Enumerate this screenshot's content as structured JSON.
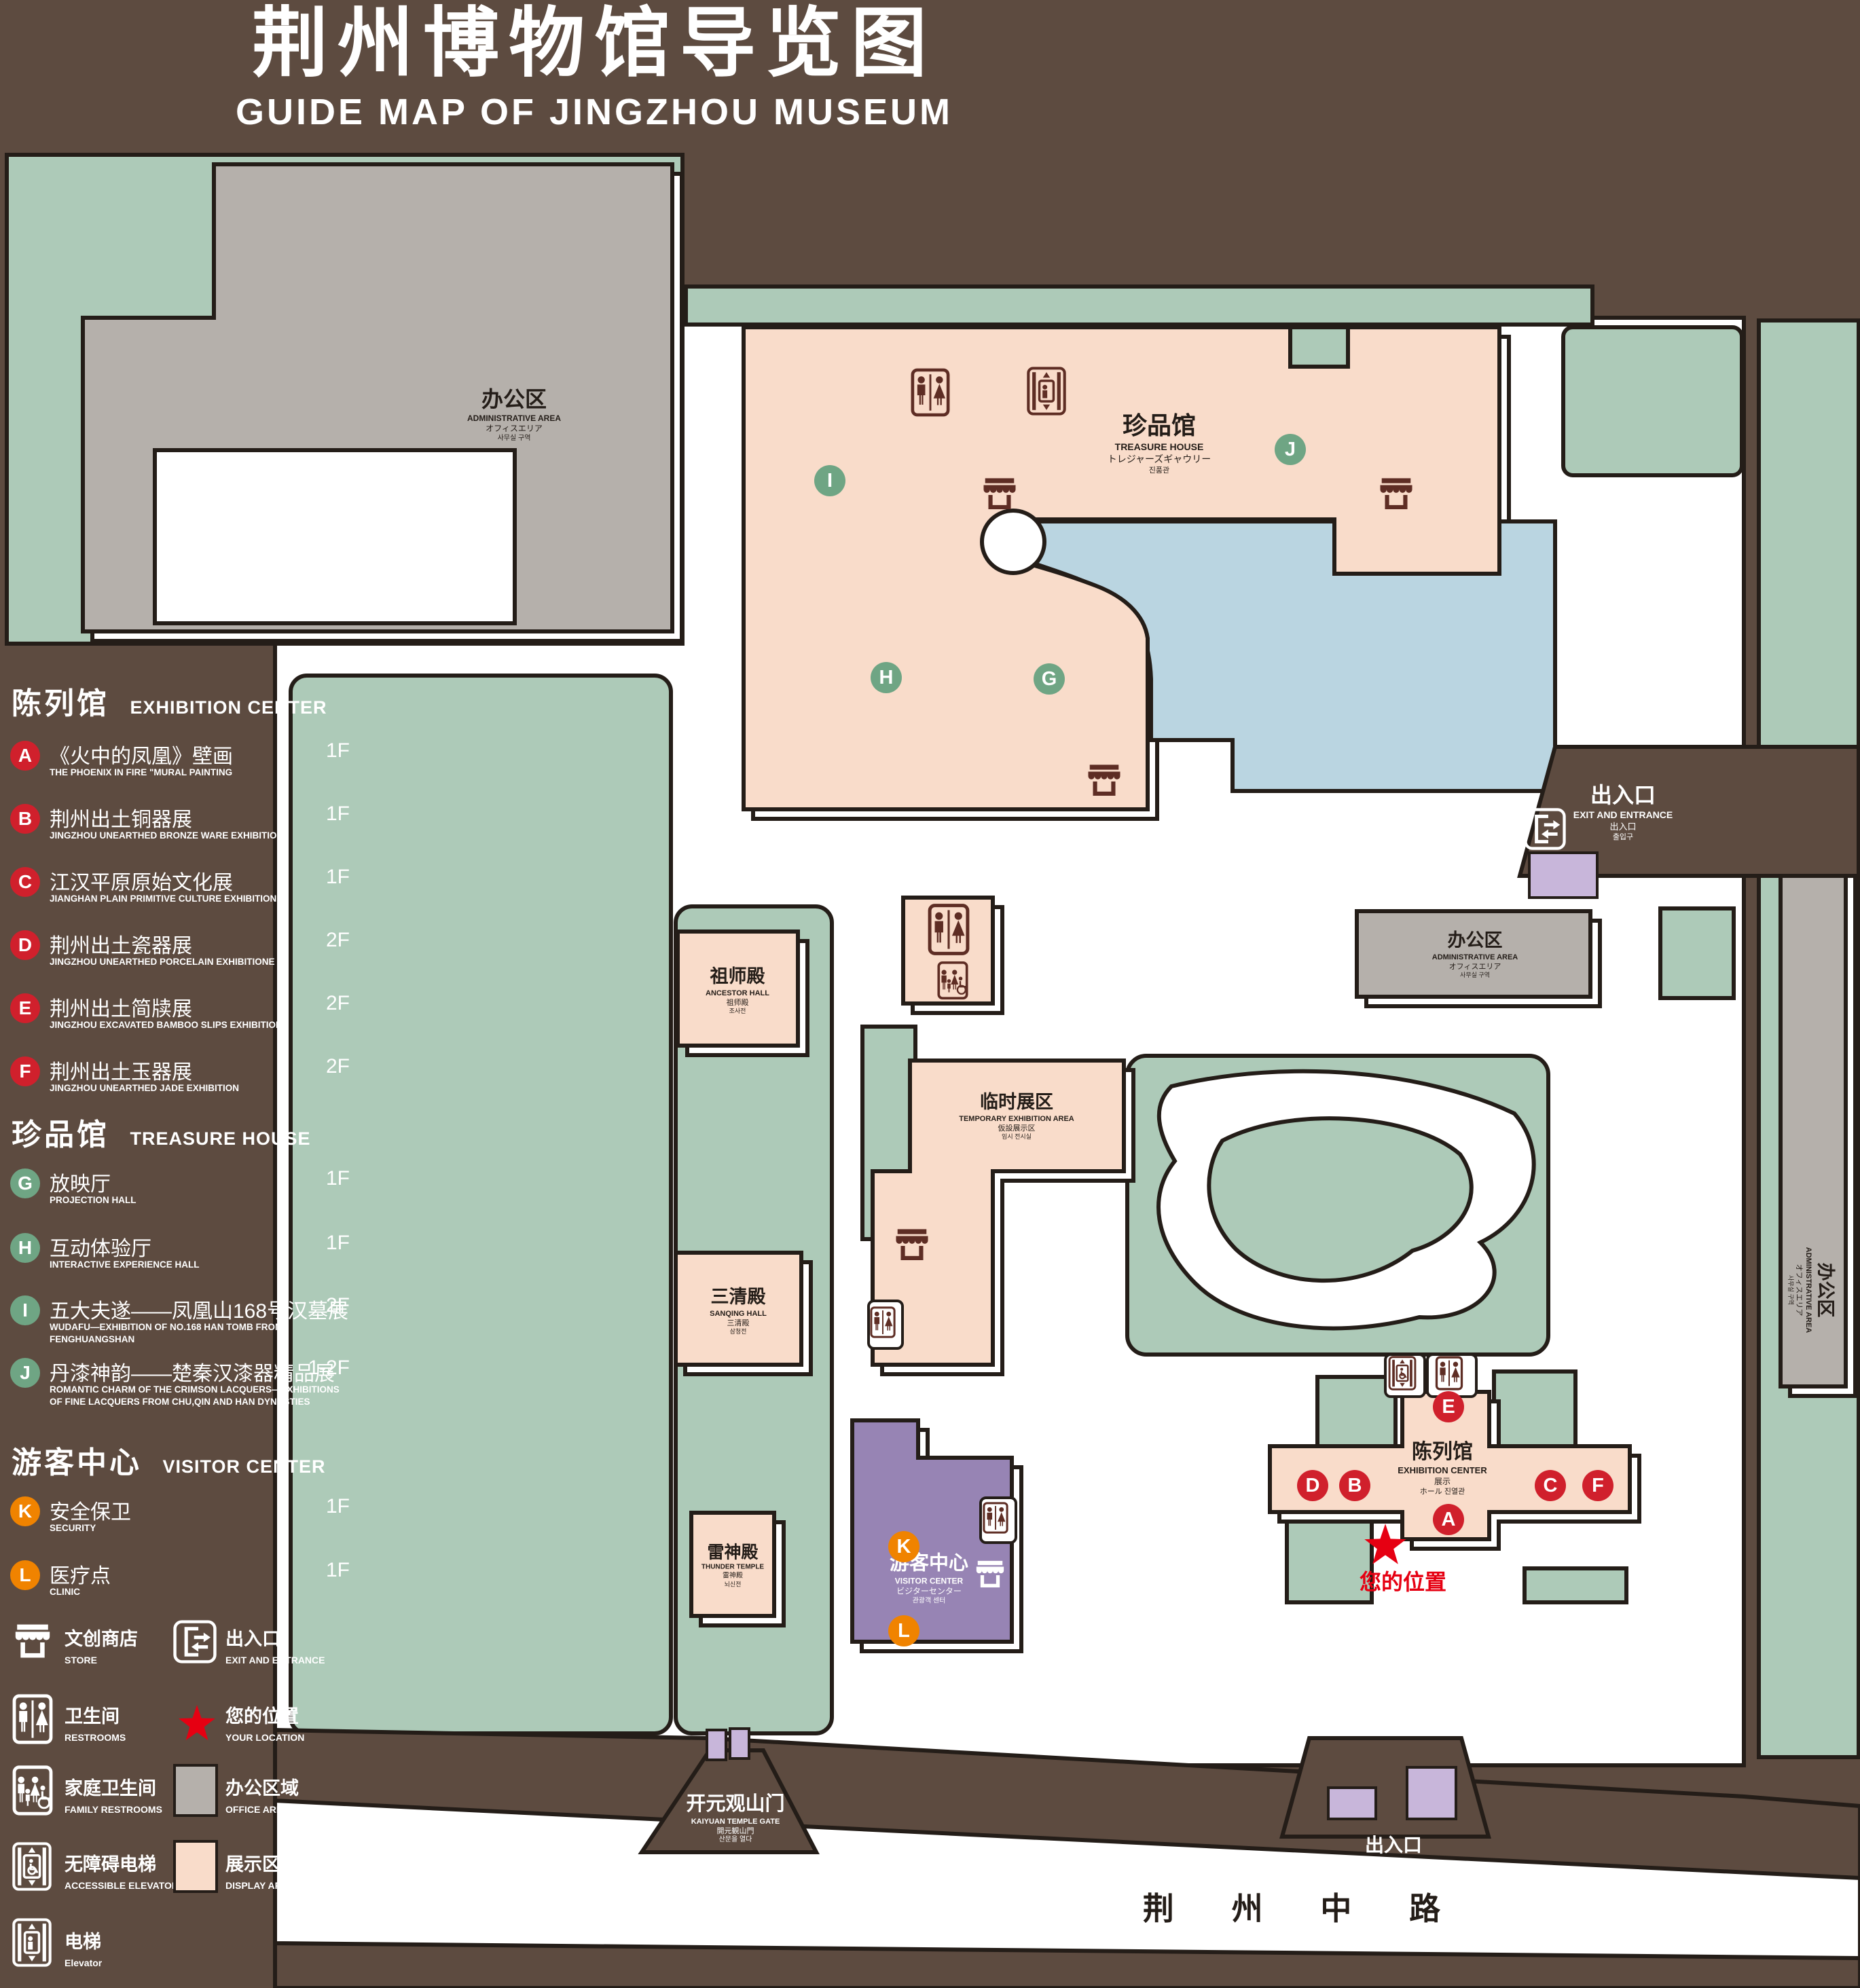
{
  "title": {
    "zh": "荆州博物馆导览图",
    "en": "GUIDE MAP OF JINGZHOU MUSEUM"
  },
  "legend": {
    "sections": [
      {
        "zh": "陈列馆",
        "en": "EXHIBITION CENTER"
      },
      {
        "zh": "珍品馆",
        "en": "TREASURE HOUSE"
      },
      {
        "zh": "游客中心",
        "en": "VISITOR CENTER"
      }
    ],
    "items": [
      {
        "letter": "A",
        "zh": "《火中的凤凰》壁画",
        "en": "THE PHOENIX IN FIRE \"MURAL PAINTING",
        "floor": "1F",
        "color": "red"
      },
      {
        "letter": "B",
        "zh": "荆州出土铜器展",
        "en": "JINGZHOU UNEARTHED BRONZE WARE EXHIBITION",
        "floor": "1F",
        "color": "red"
      },
      {
        "letter": "C",
        "zh": "江汉平原原始文化展",
        "en": "JIANGHAN PLAIN PRIMITIVE CULTURE EXHIBITION",
        "floor": "1F",
        "color": "red"
      },
      {
        "letter": "D",
        "zh": "荆州出土瓷器展",
        "en": "JINGZHOU UNEARTHED PORCELAIN EXHIBITIONE",
        "floor": "2F",
        "color": "red"
      },
      {
        "letter": "E",
        "zh": "荆州出土简牍展",
        "en": "JINGZHOU EXCAVATED BAMBOO SLIPS EXHIBITION",
        "floor": "2F",
        "color": "red"
      },
      {
        "letter": "F",
        "zh": "荆州出土玉器展",
        "en": "JINGZHOU UNEARTHED JADE EXHIBITION",
        "floor": "2F",
        "color": "red"
      },
      {
        "letter": "G",
        "zh": "放映厅",
        "en": "PROJECTION HALL",
        "floor": "1F",
        "color": "green"
      },
      {
        "letter": "H",
        "zh": "互动体验厅",
        "en": "INTERACTIVE EXPERIENCE HALL",
        "floor": "1F",
        "color": "green"
      },
      {
        "letter": "I",
        "zh": "五大夫遂——凤凰山168号汉墓展",
        "en": "WUDAFU—EXHIBITION OF NO.168 HAN TOMB FROM FENGHUANGSHAN",
        "floor": "2F",
        "color": "green"
      },
      {
        "letter": "J",
        "zh": "丹漆神韵——楚秦汉漆器精品展",
        "en": "ROMANTIC CHARM OF THE CRIMSON LACQUERS—EXHIBITIONS OF FINE LACQUERS FROM CHU,QIN AND HAN DYNASTIES",
        "floor": "1-2F",
        "color": "green"
      },
      {
        "letter": "K",
        "zh": "安全保卫",
        "en": "SECURITY",
        "floor": "1F",
        "color": "orange"
      },
      {
        "letter": "L",
        "zh": "医疗点",
        "en": "CLINIC",
        "floor": "1F",
        "color": "orange"
      }
    ],
    "symbols": [
      {
        "zh": "文创商店",
        "en": "STORE",
        "icon": "store"
      },
      {
        "zh": "出入口",
        "en": "EXIT AND ENTRANCE",
        "icon": "exit"
      },
      {
        "zh": "卫生间",
        "en": "RESTROOMS",
        "icon": "restrooms"
      },
      {
        "zh": "您的位置",
        "en": "YOUR LOCATION",
        "icon": "star"
      },
      {
        "zh": "家庭卫生间",
        "en": "FAMILY RESTROOMS",
        "icon": "family-restrooms"
      },
      {
        "zh": "办公区域",
        "en": "OFFICE AREA",
        "icon": "gray-square"
      },
      {
        "zh": "无障碍电梯",
        "en": "ACCESSIBLE ELEVATOR",
        "icon": "accessible-elevator"
      },
      {
        "zh": "展示区域",
        "en": "DISPLAY AREA",
        "icon": "pink-square"
      },
      {
        "zh": "电梯",
        "en": "Elevator",
        "icon": "elevator"
      }
    ]
  },
  "map": {
    "buildings": {
      "admin": {
        "zh": "办公区",
        "en": "ADMINISTRATIVE AREA",
        "jp": "オフィスエリア",
        "kr": "사무실 구역"
      },
      "treasure": {
        "zh": "珍品馆",
        "en": "TREASURE HOUSE",
        "jp": "トレジャーズギャウリー",
        "kr": "진품관"
      },
      "ancestor": {
        "zh": "祖师殿",
        "en": "ANCESTOR HALL",
        "jp": "祖师殿",
        "kr": "조사전"
      },
      "temp": {
        "zh": "临时展区",
        "en": "TEMPORARY EXHIBITION AREA",
        "jp": "仮設展示区",
        "kr": "임시 전시실"
      },
      "sanqing": {
        "zh": "三清殿",
        "en": "SANQING HALL",
        "jp": "三清殿",
        "kr": "삼청전"
      },
      "thunder": {
        "zh": "雷神殿",
        "en": "THUNDER TEMPLE",
        "jp": "雷神殿",
        "kr": "뇌신전"
      },
      "visitor": {
        "zh": "游客中心",
        "en": "VISITOR CENTER",
        "jp": "ビジターセンター",
        "kr": "관광객 센터"
      },
      "exhibition": {
        "zh": "陈列馆",
        "en": "EXHIBITION CENTER",
        "jp": "展示",
        "kr": "ホール 진열관"
      },
      "gate": {
        "zh": "开元观山门",
        "en": "KAIYUAN TEMPLE GATE",
        "jp": "開元観山門",
        "kr": "산문을 열다"
      },
      "exit": {
        "zh": "出入口",
        "en": "EXIT AND ENTRANCE",
        "jp": "出入口",
        "kr": "출입구"
      }
    },
    "your_location": "您的位置",
    "road": "荆 州 中 路"
  },
  "colors": {
    "background_brown": "#5d4b40",
    "outline": "#241d18",
    "lawn_green": "#adcab8",
    "display_pink": "#f9dcca",
    "office_gray": "#b5b0ab",
    "visitor_purple": "#9784b4",
    "gate_purple": "#c8b6da",
    "pond_blue": "#bad5e1",
    "icon_maroon": "#5e2d24",
    "marker_red": "#d0202c",
    "marker_green": "#6fa584",
    "marker_orange": "#f08300",
    "location_red": "#e60012"
  }
}
